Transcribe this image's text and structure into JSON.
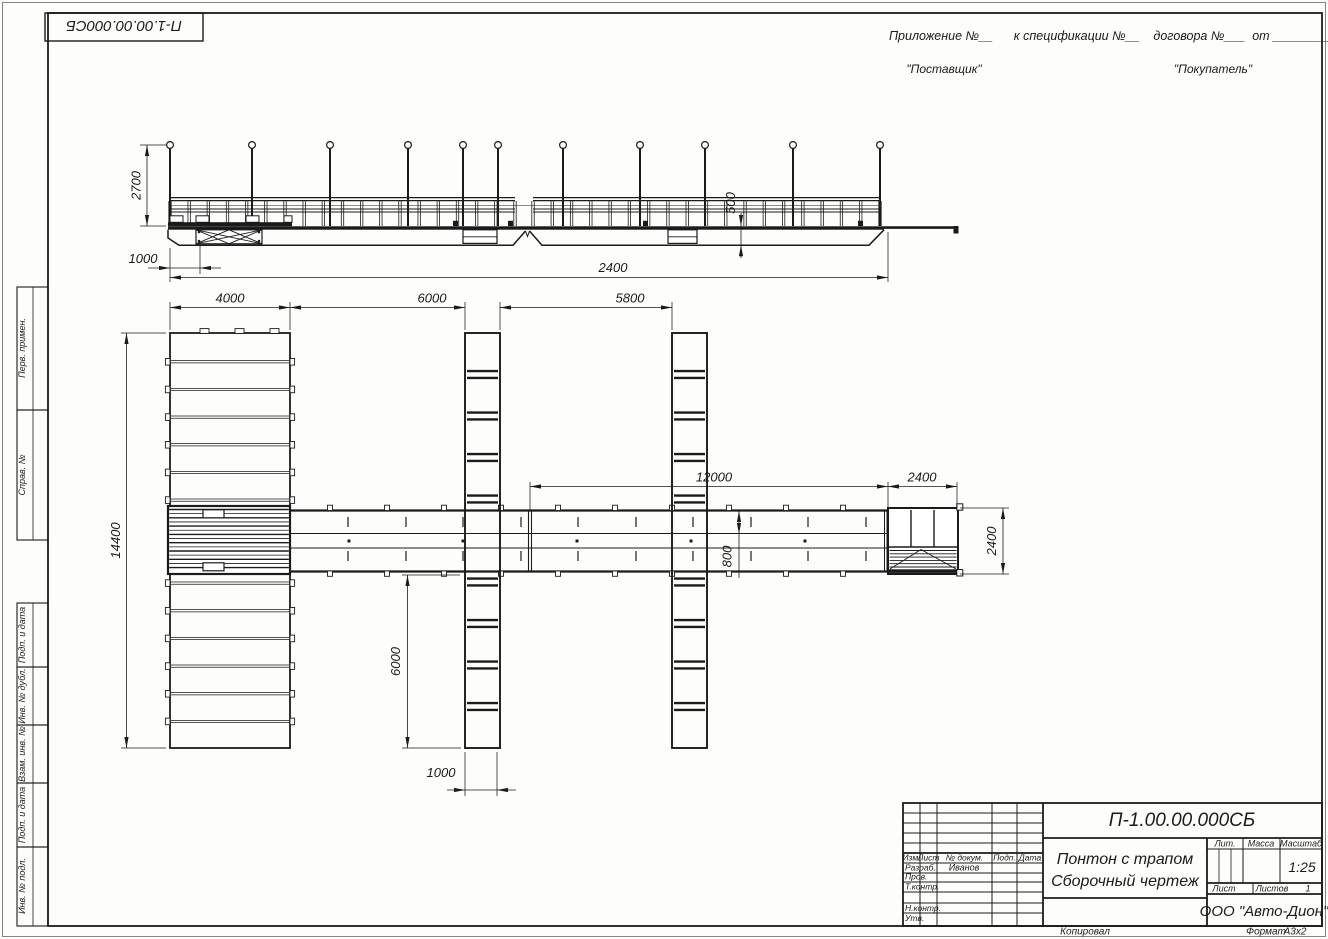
{
  "document": {
    "designation": "П-1.00.00.000СБ",
    "title_line1": "Понтон с трапом",
    "title_line2": "Сборочный чертеж",
    "scale": "1:25",
    "sheets_value": "1",
    "company": "ООО \"Авто-Дион\"",
    "developer": "Иванов",
    "format_value": "А3х2"
  },
  "header": {
    "appendix": "Приложение №__      к спецификации №__    договора №___  от _________",
    "supplier": "\"Поставщик\"",
    "buyer": "\"Покупатель\""
  },
  "corner_stamp": {
    "designation": "П-1.00.00.000СБ"
  },
  "margin_columns": {
    "perv_primen": "Перв. примен.",
    "sprav_no": "Справ. №",
    "podp_data1": "Подп. и дата",
    "inv_dubl": "Инв. № дубл.",
    "vzam_inv": "Взам. инв. №",
    "podp_data2": "Подп. и дата",
    "inv_podl": "Инв. № подл."
  },
  "title_block_labels": {
    "izm": "Изм.",
    "list": "Лист",
    "doc": "№ докум.",
    "podp": "Подп.",
    "data": "Дата",
    "razrab": "Разраб.",
    "prov": "Пров.",
    "tkontr": "Т.контр.",
    "nkontr": "Н.контр.",
    "utv": "Утв.",
    "lit": "Лит.",
    "massa": "Масса",
    "masshtab": "Масштаб",
    "list2": "Лист",
    "listov": "Листов"
  },
  "footer": {
    "copied": "Копировал",
    "format_label": "Формат"
  },
  "dims": {
    "elev_post_height": "2700",
    "elev_ramp_offset": "1000",
    "elev_overall": "2400",
    "elev_hull_height": "500",
    "plan_pontoon_width": "4000",
    "plan_gap1": "6000",
    "plan_gap2": "5800",
    "plan_walkway_run": "12000",
    "plan_gangway_len": "2400",
    "plan_overall_width": "14400",
    "plan_walk_width": "800",
    "plan_gangway_width": "2400",
    "plan_finger_length": "6000",
    "plan_finger_width": "1000"
  }
}
